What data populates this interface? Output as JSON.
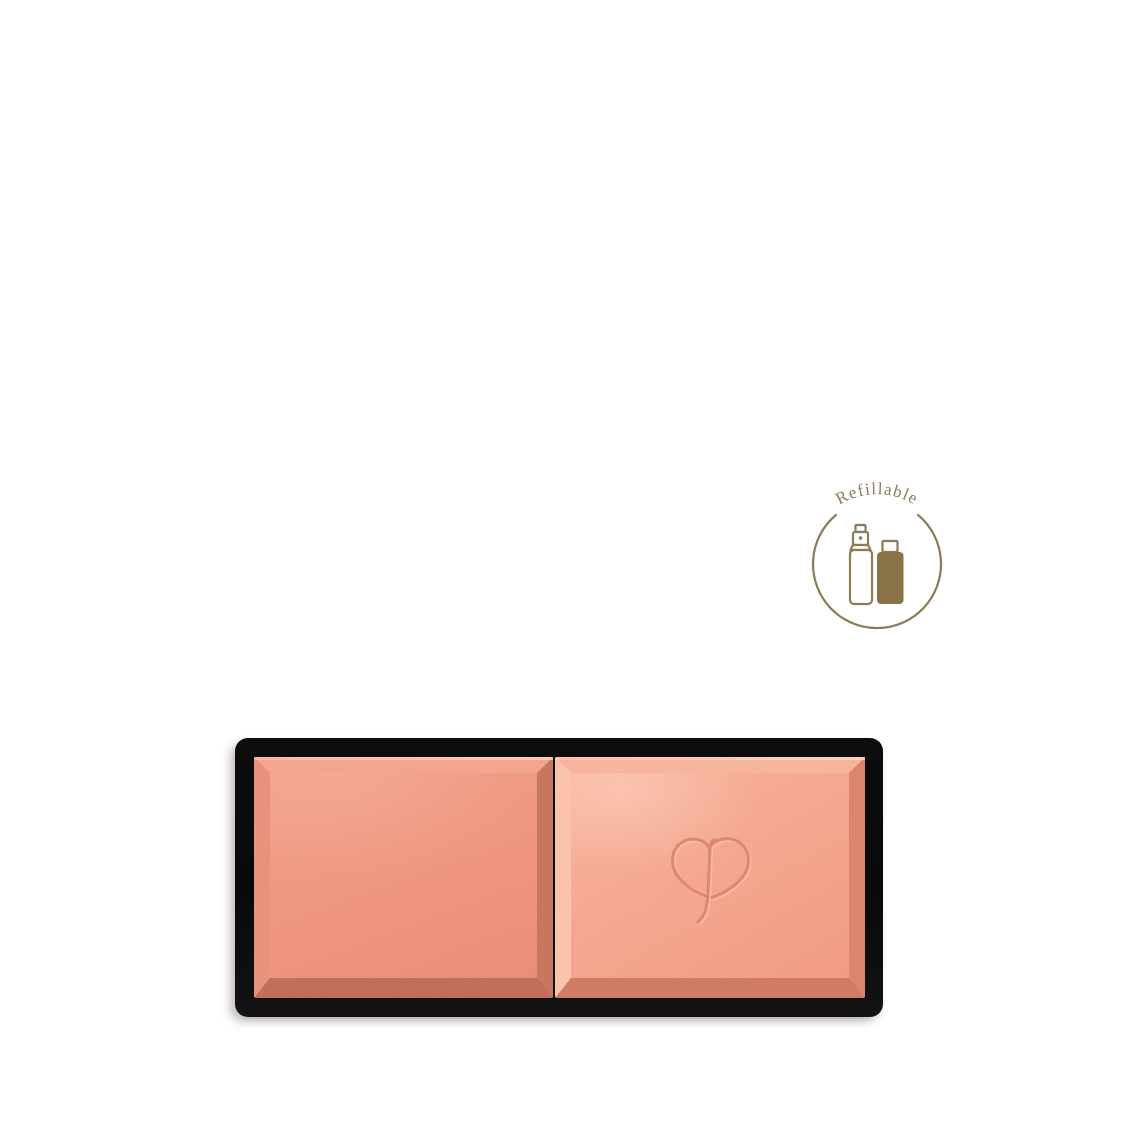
{
  "badge": {
    "label": "Refillable",
    "color": "#8c7b55",
    "icon_fill_color": "#8a7347",
    "icons": [
      "spray-bottle-icon",
      "refill-cartridge-icon"
    ]
  },
  "product": {
    "kind": "powder-blush-refill-pan",
    "pan_count": 2,
    "tray_color": "#0a0a0a",
    "shade_left_hex": "#ef947e",
    "shade_right_hex": "#f4a48d",
    "logo_icon": "cle-de-peau-monogram-icon"
  },
  "page": {
    "background": "#ffffff"
  }
}
